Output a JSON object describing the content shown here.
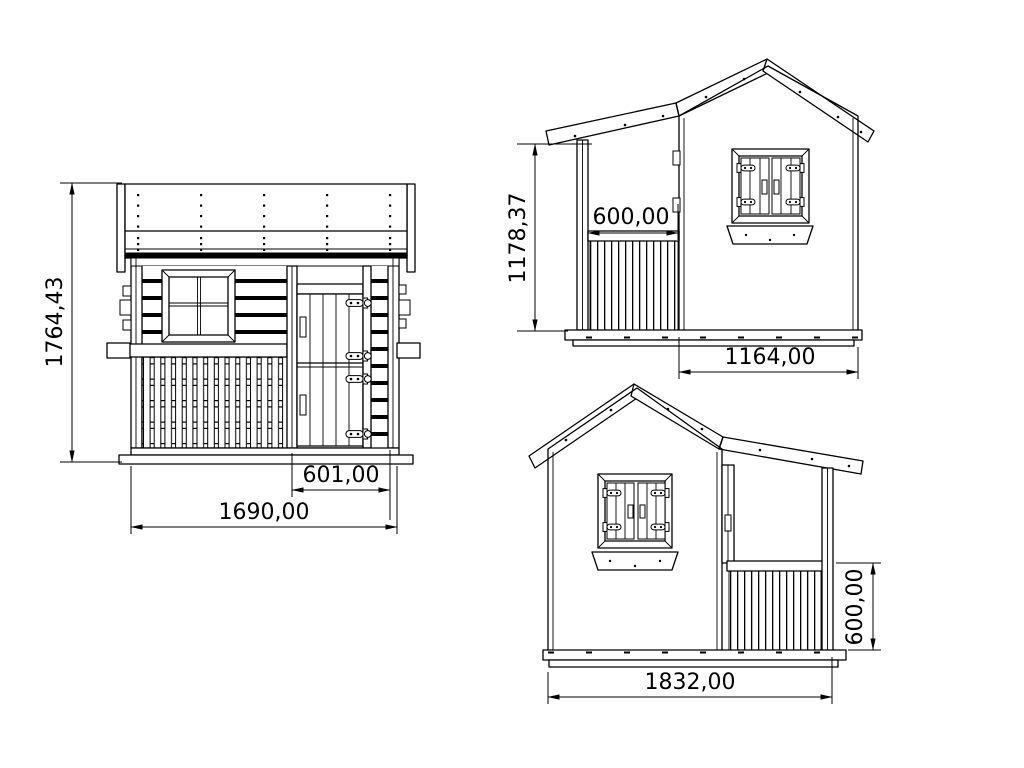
{
  "colors": {
    "background": "#ffffff",
    "line": "#000000"
  },
  "views": {
    "front": {
      "height": "1764,43",
      "door_width": "601,00",
      "total_width": "1690,00"
    },
    "side_a": {
      "wall_height": "1178,37",
      "porch_depth": "600,00",
      "cabin_depth": "1164,00"
    },
    "side_b": {
      "railing_height": "600,00",
      "total_depth": "1832,00"
    }
  }
}
